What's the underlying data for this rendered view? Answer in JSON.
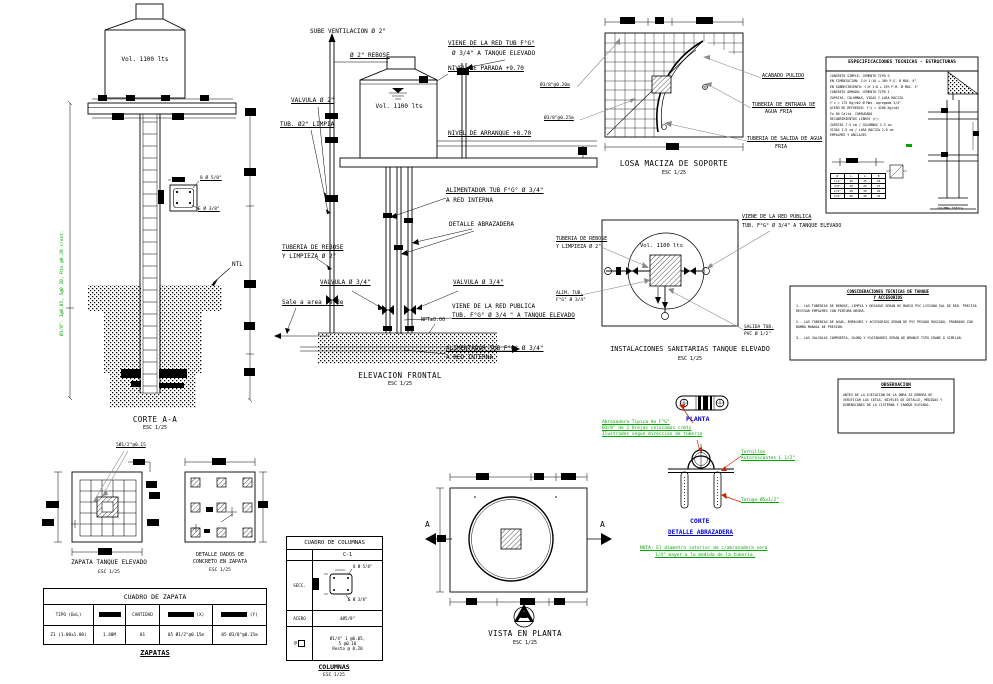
{
  "palette": {
    "line": "#000000",
    "green": "#00a400",
    "blue": "#0000cc",
    "red": "#cc2200",
    "gray": "#8a8a8a"
  },
  "corte": {
    "title": "CORTE A-A",
    "scale": "ESC 1/25",
    "volume": "Vol. 1100 lts",
    "ntl": "NTL",
    "stirrups": "Ø3/8\": 1@0.05, 5@0.10, Rto.@0.20 c/ext.",
    "bar_top": "8 Ø 5/8\"",
    "bar_bottom": "E Ø 3/8\""
  },
  "elevacion": {
    "title": "ELEVACION FRONTAL",
    "scale": "ESC 1/25",
    "volume": "Vol. 1100 lts",
    "vent": "SUBE VENTILACION Ø 2\"",
    "rebose": "Ø 2\" REBOSE",
    "viene_red_1": "VIENE DE LA RED TUB F°G°",
    "viene_red_2": "Ø 3/4\" A TANQUE ELEVADO",
    "nivel_parada": "NIVEL DE PARADA +9.70",
    "valvula_2": "VALVULA Ø 2\"",
    "tub_limpia": "TUB. Ø2\" LIMPIA",
    "nivel_arranque": "NIVEL DE ARRANQUE +8.70",
    "alimentador_1a": "ALIMENTADOR TUB F°G° Ø 3/4\"",
    "alimentador_1b": "A RED INTERNA",
    "detalle_abrazadera": "DETALLE ABRAZADERA",
    "tuberia_rebose_1": "TUBERIA DE REBOSE",
    "tuberia_rebose_2": "Y LIMPIEZA Ø 2\"",
    "valvula_34_izq": "VALVULA Ø 3/4\"",
    "valvula_34_der": "VALVULA Ø 3/4\"",
    "sale_verde": "Sale a area verde",
    "red_publica_1": "VIENE DE LA RED PUBLICA",
    "red_publica_2": "TUB. F°G° Ø 3/4 \" A TANQUE ELEVADO",
    "npt": "NPT±0.00",
    "alimentador_2a": "ALIMENTADOR TUB F°G° Ø 3/4\"",
    "alimentador_2b": "A RED INTERNA"
  },
  "losa": {
    "title": "LOSA MACIZA DE SOPORTE",
    "scale": "ESC 1/25",
    "rebar_1": "Ø3/8\"@0.20m",
    "rebar_2": "Ø3/8\"@0.25m",
    "acabado": "ACABADO PULIDO",
    "entrada_1": "TUBERIA DE ENTRADA DE",
    "entrada_2": "AGUA FRIA",
    "salida_1": "TUBERIA DE SALIDA DE AGUA",
    "salida_2": "FRIA"
  },
  "especificaciones": {
    "title": "ESPECIFICACIONES  TECNICAS - ESTRUCTURAS",
    "lines": [
      "CONCRETO SIMPLE:  CEMENTO TIPO G",
      "EN CIMENTACION:  C:H 1:10 + 30% P.G. Ø MAX. 6\"",
      "EN SOBRECIMIENTO:  C:H 1:8 + 25% P.M. Ø MAX. 3\"",
      "CONCRETO ARMADO:  CEMENTO TIPO I",
      "ZAPATAS, COLUMNAS, VIGAS Y LOSA MACIZA",
      "f'c = 175 Kg/cm2   Ø Max. agregado 3/4\"",
      "ACERO DE REFUERZO:  f'y = 4200 Kg/cm2",
      "Fo 60 Calid.  CORRUGADO",
      "RECUBRIMIENTOS LIBRES (r):",
      "ZAPATAS 7.5 cm / COLUMNAS 2.5 cm",
      "VIGAS 2.5 cm / LOSA MACIZA 2.0 cm",
      "EMPALMES Y ANCLAJES"
    ],
    "empalme_table": {
      "headers": [
        "Ø",
        "L",
        "A",
        "B"
      ],
      "rows": [
        [
          "1/4\"",
          "20",
          "15",
          "10"
        ],
        [
          "3/8\"",
          "30",
          "25",
          "15"
        ],
        [
          "1/2\"",
          "40",
          "30",
          "20"
        ],
        [
          "5/8\"",
          "50",
          "40",
          "25"
        ]
      ]
    },
    "columna_label": "COLUMNA TIPICA"
  },
  "instalaciones": {
    "title": "INSTALACIONES SANITARIAS TANQUE ELEVADO",
    "scale": "ESC 1/25",
    "volume": "Vol. 1100 lts",
    "rebose_1": "TUBERIA DE REBOSE",
    "rebose_2": "Y LIMPIEZA Ø 2\"",
    "publica_1": "VIENE DE LA RED PUBLICA",
    "publica_2": "TUB. F°G° Ø 3/4\" A TANQUE ELEVADO",
    "alim_1": "ALIM. TUB.",
    "alim_2": "F°G° Ø 3/4\"",
    "salida_1": "SALIDA TUB.",
    "salida_2": "PVC Ø 1/2\""
  },
  "consideraciones": {
    "titulo_1": "CONSIDERACIONES TECNICAS DE TANQUE",
    "titulo_2": "Y ACCESORIOS",
    "items": [
      "1.- LAS TUBERIAS DE REBOSE, LIMPIA Y DESAGUE SERAN DE MARCO PVC LIVIANO SAL DE RED. PRECISA REVISAR EMPALMES CON PINTURA NEGRA.",
      "2.- LAS TUBERIAS DE AGUA, EMPALMES Y ACCESORIOS SERAN DE PVC PESADO ROSCADO, PROBADOS CON BOMBA MANUAL DE PRESION.",
      "3.- LAS VALVULAS COMPUERTA, GLOBO Y FLOTADORES SERAN DE BRONCE TIPO CRANE O SIMILAR."
    ]
  },
  "observacion": {
    "title": "OBSERVACION",
    "text": "ANTES DE LA EJECUCION DE LA OBRA SE DEBERA DE VERIFICAR LAS COTAS, NIVELES DE DETALLE, MEDIDAS Y DIMENSIONES DE LA CISTERNA Y TANQUE ELEVADO."
  },
  "abrazadera": {
    "planta": "PLANTA",
    "corte": "CORTE",
    "detalle": "DETALLE ABRAZADERA",
    "nota_verde_1": "Abrazadera Tipica de F°G°",
    "nota_verde_2": "Ø1/8\" de 2 Orejas colocados c/mts",
    "nota_verde_3": "Ilustrados segun direccion de tuberia",
    "tornillos_1": "Tornillos",
    "tornillos_2": "Autoroscantes L 1/2\"",
    "tarugo": "Tarugo Ø5x1/2\"",
    "nota_1": "NOTA: El diametro interior de c/abrazadera sera",
    "nota_2": "1/4\" mayor a la medida de la tuberia."
  },
  "vista": {
    "title": "VISTA EN PLANTA",
    "scale": "ESC 1/25",
    "marker": "A"
  },
  "zapata": {
    "title": "ZAPATA TANQUE ELEVADO",
    "scale": "ESC 1/25",
    "rebar": "5Ø1/2\"@0.15"
  },
  "dados": {
    "title_1": "DETALLE DADOS DE",
    "title_2": "CONCRETO EN ZAPATA",
    "scale": "ESC 1/25"
  },
  "cuadro_zapata": {
    "title": "CUADRO DE ZAPATA",
    "h_tipo": "TIPO (BxL)",
    "h_cantidad": "CANTIDAD",
    "h_x": "(X)",
    "h_y": "(Y)",
    "r_tipo": "Z1 (1.00x1.00)",
    "r_peralte": "1.40M",
    "r_cantidad": "01",
    "r_x": "05 Ø1/2\"@0.15m",
    "r_y": "05 Ø3/8\"@0.15m",
    "footer": "ZAPATAS"
  },
  "cuadro_columnas": {
    "title": "CUADRO DE COLUMNAS",
    "col": "C-1",
    "secc": "SECC.",
    "bar_top": "8 Ø 5/8\"",
    "bar_bottom": "E Ø 3/8\"",
    "acero_label": "ACERO",
    "acero_valor": "4Ø5/8\"",
    "estribo_label": "Ø",
    "estribo_1": "Ø1/4\" 1 @0.05,",
    "estribo_2": "5 @0.10",
    "estribo_3": "Resto @ 0.20",
    "footer": "COLUMNAS",
    "scale": "ESC 1/25"
  }
}
